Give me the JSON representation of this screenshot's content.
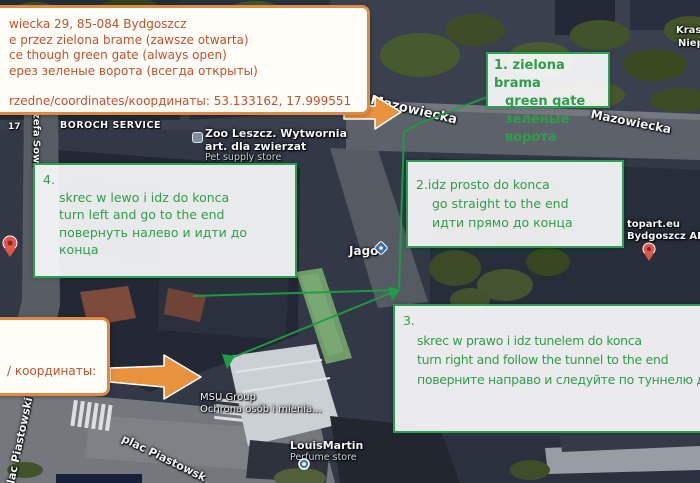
{
  "colors": {
    "annotation_green": "#2e9e4a",
    "annotation_orange_border": "#dd8a42",
    "annotation_orange_text": "#c4512c",
    "arrow_orange": "#e8923e",
    "route_green": "#1f9d44",
    "pin_red": "#df564a",
    "pin_blue": "#4a79b5"
  },
  "annotations": {
    "address_box": {
      "lines": [
        "wiecka 29, 85-084 Bydgoszcz",
        "e przez zielona brame (zawsze otwarta)",
        "ce though green gate (always open)",
        "ерез зеленые ворота (всегда открыты)",
        "rzedne/coordinates/координаты: 53.133162, 17.999551"
      ]
    },
    "coords_box": {
      "text": "/ координаты:"
    },
    "step1": {
      "line1": "1. zielona brama",
      "line2": "green gate",
      "line3": "зеленые ворота"
    },
    "step2": {
      "line1": "2.idz prosto do konca",
      "line2": "go straight to the end",
      "line3": "идти прямо до конца"
    },
    "step3": {
      "number": "3.",
      "line1": "skrec w prawo i idz tunelem do konca",
      "line2": "turn right and follow the tunnel to the end",
      "line3": "поверните направо и следуйте по туннелю д"
    },
    "step4": {
      "number": "4.",
      "line1": "skrec w lewo i idz do konca",
      "line2": "turn left and go to the end",
      "line3": "повернуть налево и идти до конца"
    }
  },
  "map_labels": {
    "mazowiecka_west": "Mazowiecka",
    "mazowiecka_east": "Mazowiecka",
    "jozefa_sowinskiego": "ózefa Sowi",
    "plac_piastowski_west": "plac Piastowski",
    "plac_piastowski_south": "plac Piastowsk",
    "krasinskiego_partial": "Kras",
    "niepodleglosci_partial": "Niep",
    "house_number": "17",
    "boroch_service": "BOROCH SERVICE",
    "zoo_name_line1": "Zoo Leszcz. Wytwornia",
    "zoo_name_line2": "art. dla zwierzat",
    "zoo_category": "Pet supply store",
    "jago": "Jago",
    "topart_line1": "topart.eu",
    "topart_line2": "Bydgoszcz AB",
    "louismartin_name": "LouisMartin",
    "louismartin_category": "Perfume store",
    "msu_name": "MSU Group",
    "msu_category": "Ochrona osób i mienia..."
  }
}
